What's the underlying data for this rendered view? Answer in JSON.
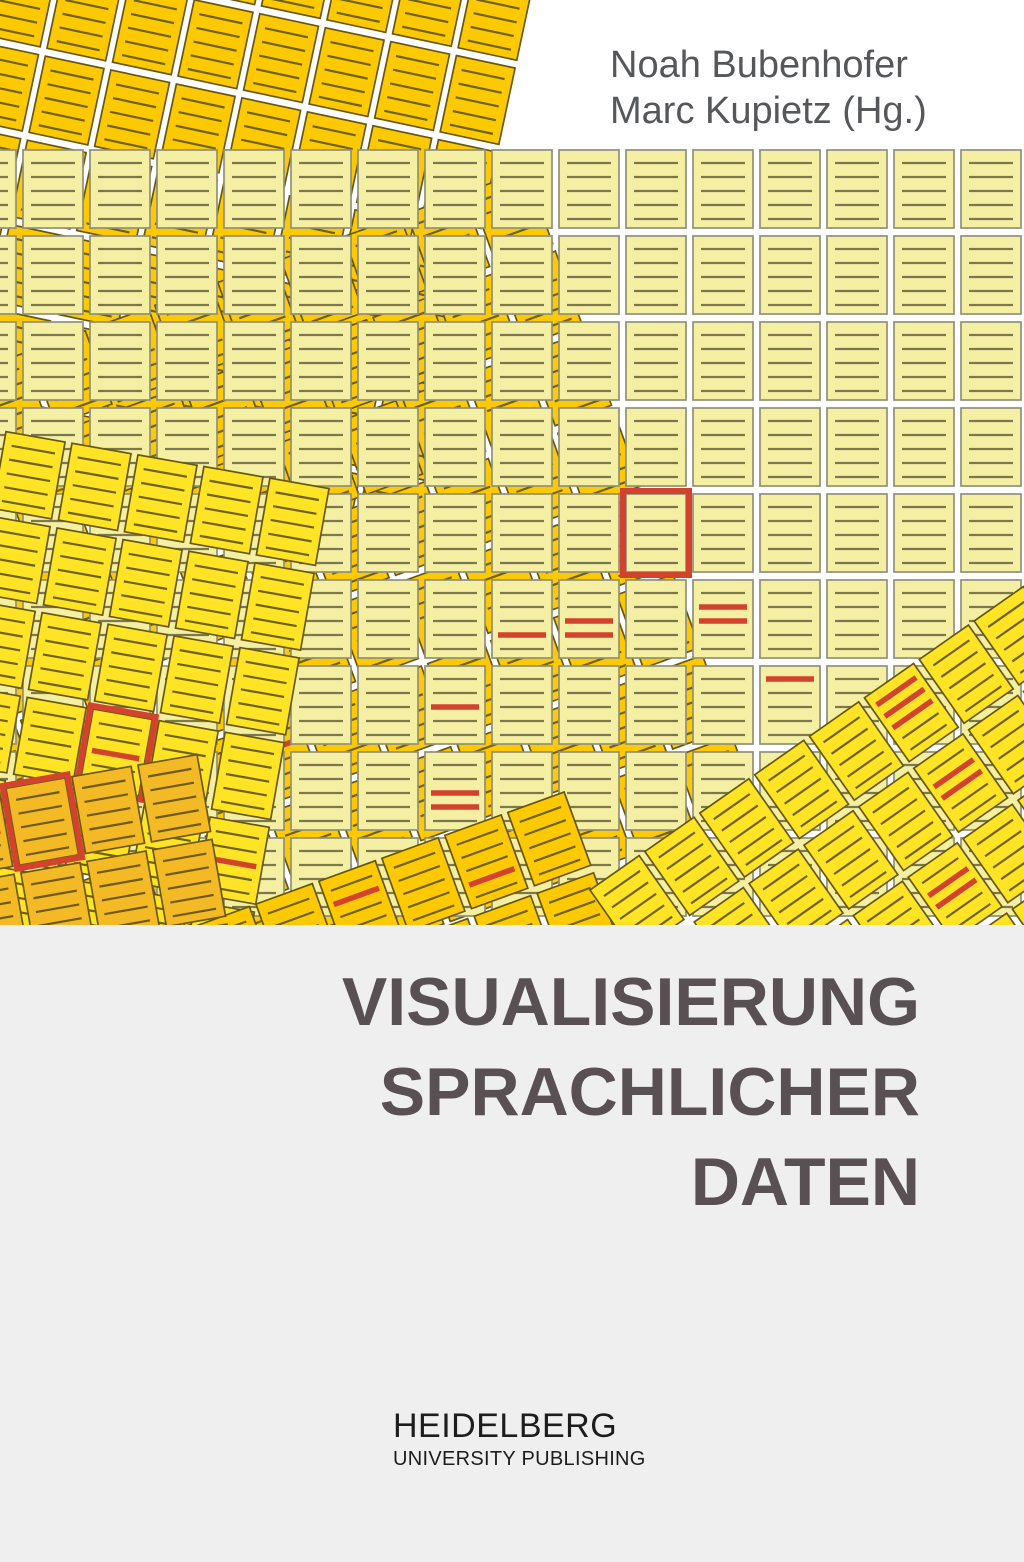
{
  "cover": {
    "authors": [
      "Noah Bubenhofer",
      "Marc Kupietz (Hg.)"
    ],
    "title_lines": [
      "VISUALISIERUNG",
      "SPRACHLICHER",
      "DATEN"
    ],
    "publisher": {
      "name": "HEIDELBERG",
      "subtitle": "UNIVERSITY PUBLISHING"
    },
    "colors": {
      "background": "#ffffff",
      "panel_grey": "#f0eff0",
      "title_text": "#585052",
      "author_text": "#55575a",
      "publisher_text": "#1d1d1d",
      "highlight_red": "#d2422c"
    }
  },
  "artwork": {
    "description": "overlapping-grids-of-lined-document-icons",
    "red": "#d2422c",
    "tile": {
      "w": 60,
      "h": 78,
      "pitch_x": 67,
      "pitch_y": 86,
      "lines": 5
    },
    "grids": [
      {
        "id": "gold-top-left",
        "fill": "#fcc903",
        "stroke": "#66590f",
        "line": "#6e6215",
        "rotation": 12,
        "x": -50,
        "y": -140,
        "cols": 9,
        "rows": 7,
        "marks": []
      },
      {
        "id": "gold-under-left",
        "fill": "#fcc903",
        "stroke": "#66590f",
        "line": "#6e6215",
        "rotation": -20,
        "x": -160,
        "y": 420,
        "cols": 11,
        "rows": 8,
        "marks": [
          {
            "col": 4,
            "row": 5,
            "red_lines": [
              1
            ]
          }
        ]
      },
      {
        "id": "pale-straight-grid",
        "fill": "#f5efa3",
        "stroke": "#90907a",
        "line": "#7d7750",
        "rotation": 0,
        "x": -44,
        "y": 150,
        "cols": 16,
        "rows": 9,
        "marks": [
          {
            "col": 10,
            "row": 4,
            "red_border": true
          },
          {
            "col": 8,
            "row": 5,
            "red_lines": [
              3
            ]
          },
          {
            "col": 9,
            "row": 5,
            "red_lines": [
              2,
              3
            ]
          },
          {
            "col": 11,
            "row": 5,
            "red_lines": [
              1,
              2
            ]
          },
          {
            "col": 7,
            "row": 6,
            "red_lines": [
              2
            ]
          },
          {
            "col": 12,
            "row": 6,
            "red_lines": [
              0
            ]
          },
          {
            "col": 7,
            "row": 7,
            "red_lines": [
              2,
              3
            ]
          }
        ]
      },
      {
        "id": "bright-yellow-left",
        "fill": "#ffe426",
        "stroke": "#665a12",
        "line": "#6e6215",
        "rotation": 10,
        "x": -60,
        "y": 420,
        "cols": 6,
        "rows": 6,
        "marks": [
          {
            "col": 3,
            "row": 3,
            "red_border": true,
            "red_lines": [
              2
            ]
          },
          {
            "col": 5,
            "row": 4,
            "red_lines": [
              2
            ]
          }
        ]
      },
      {
        "id": "gold-bottom-band",
        "fill": "#fcc903",
        "stroke": "#66590f",
        "line": "#6e6215",
        "rotation": -20,
        "x": 130,
        "y": 950,
        "cols": 7,
        "rows": 2,
        "marks": [
          {
            "col": 3,
            "row": 0,
            "red_lines": [
              1
            ]
          },
          {
            "col": 5,
            "row": 0,
            "red_lines": [
              3
            ]
          }
        ]
      },
      {
        "id": "amber-bottom-corner",
        "fill": "#f3ba25",
        "stroke": "#6b5a10",
        "line": "#6e5a15",
        "rotation": -10,
        "x": -60,
        "y": 800,
        "cols": 4,
        "rows": 3,
        "marks": [
          {
            "col": 1,
            "row": 0,
            "red_border": true
          },
          {
            "col": 0,
            "row": 0,
            "red_lines": [
              2
            ]
          }
        ]
      },
      {
        "id": "bright-yellow-bottom-right",
        "fill": "#ffe426",
        "stroke": "#665a12",
        "line": "#6e6215",
        "rotation": -35,
        "x": 590,
        "y": 890,
        "cols": 8,
        "rows": 5,
        "marks": [
          {
            "col": 5,
            "row": 0,
            "red_lines": [
              0,
              1,
              2
            ]
          },
          {
            "col": 5,
            "row": 1,
            "red_lines": [
              1,
              2
            ]
          },
          {
            "col": 4,
            "row": 2,
            "red_lines": [
              1,
              2
            ]
          }
        ]
      }
    ]
  }
}
